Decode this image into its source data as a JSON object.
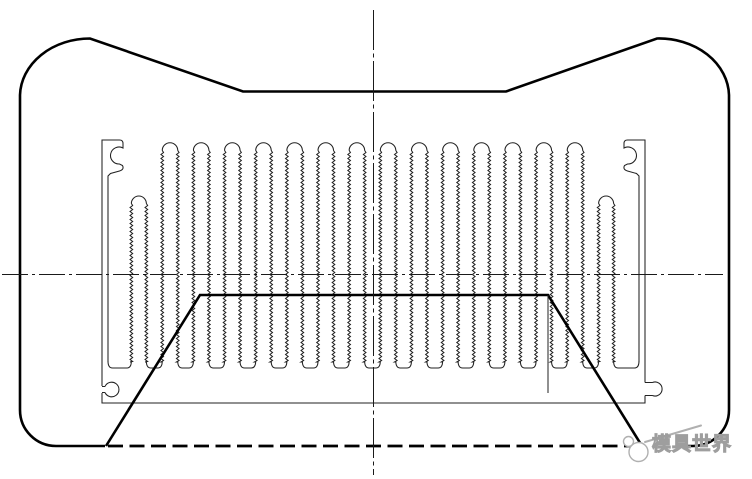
{
  "document": {
    "type": "cad-cross-section-drawing",
    "subject": "heatsink extrusion profile inside die outline",
    "background_color": "#ffffff",
    "thick_line_color": "#000000",
    "thin_line_color": "#222222",
    "centerline_color": "#1a1a1a",
    "watermark_color": "#b0b0b0"
  },
  "watermark": {
    "text": "模具世界"
  },
  "drawing": {
    "tall_fin_count": 14,
    "short_fin_count": 2,
    "fin_pitch": 31.15,
    "first_fin_x": 170,
    "fin_half_width": 7.75,
    "tall_cap_center_y": 150.5,
    "short_fin_half_width": 7.5,
    "short_cap_center_y": 203.5,
    "short_fin_centers": [
      138.85,
      606.1
    ],
    "zig_bottom_y": 362,
    "channel_bottom_y": 368,
    "plate_bottom_y": 403,
    "plate_left_x": 102,
    "plate_right_x": 645,
    "bar_inner_left_x": 108,
    "bar_inner_right_x": 639,
    "outer_contour": {
      "left": 20,
      "right": 729,
      "top": 38.5,
      "side_top_y": 95,
      "side_bottom_y": 410,
      "bottom_y": 446,
      "notch_y": 91.5,
      "notch_left_x": 243,
      "notch_right_x": 506
    },
    "trapezoid": {
      "top_y": 295,
      "top_left_x": 200,
      "top_right_x": 548,
      "bottom_left_x": 106,
      "bottom_right_x": 642,
      "bottom_y": 446
    },
    "section_marker": {
      "x": 548,
      "y1": 295,
      "y2": 393
    },
    "centerline": {
      "horizontal_y": 274.5,
      "h_x1": 2,
      "h_x2": 723,
      "vertical_x": 373.5,
      "v_y1": 10,
      "v_y2": 475
    }
  }
}
